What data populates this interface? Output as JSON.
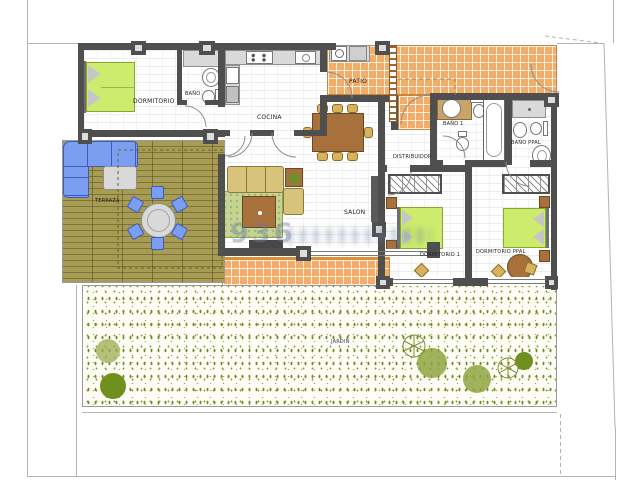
{
  "plan": {
    "watermark": "936",
    "rooms": {
      "dormitorio": {
        "label": "DORMITORIO"
      },
      "banyo": {
        "label": "BAÑO"
      },
      "cocina": {
        "label": "COCINA"
      },
      "patio": {
        "label": "PATIO"
      },
      "banyo1": {
        "label": "BAÑO 1"
      },
      "banyo_ppal": {
        "label": "BAÑO PPAL"
      },
      "distribuidor": {
        "label": "DISTRIBUIDOR"
      },
      "salon": {
        "label": "SALON"
      },
      "dormitorio1": {
        "label": "DORMITORIO 1"
      },
      "dormitorio_ppal": {
        "label": "DORMITORIO PPAL"
      },
      "terraza": {
        "label": "TERRAZA"
      },
      "jardin": {
        "label": "JARDIN"
      }
    },
    "colors": {
      "wall": "#4f4f4f",
      "tile_orange": "#f2ae69",
      "deck_wood": "#a0954c",
      "bed_green": "#cdeb6d",
      "sofa_blue": "#7b9ef0",
      "furniture_tan": "#d9b35c",
      "garden_green": "#8a9a33",
      "watermark_blue": "#697d9e"
    }
  }
}
